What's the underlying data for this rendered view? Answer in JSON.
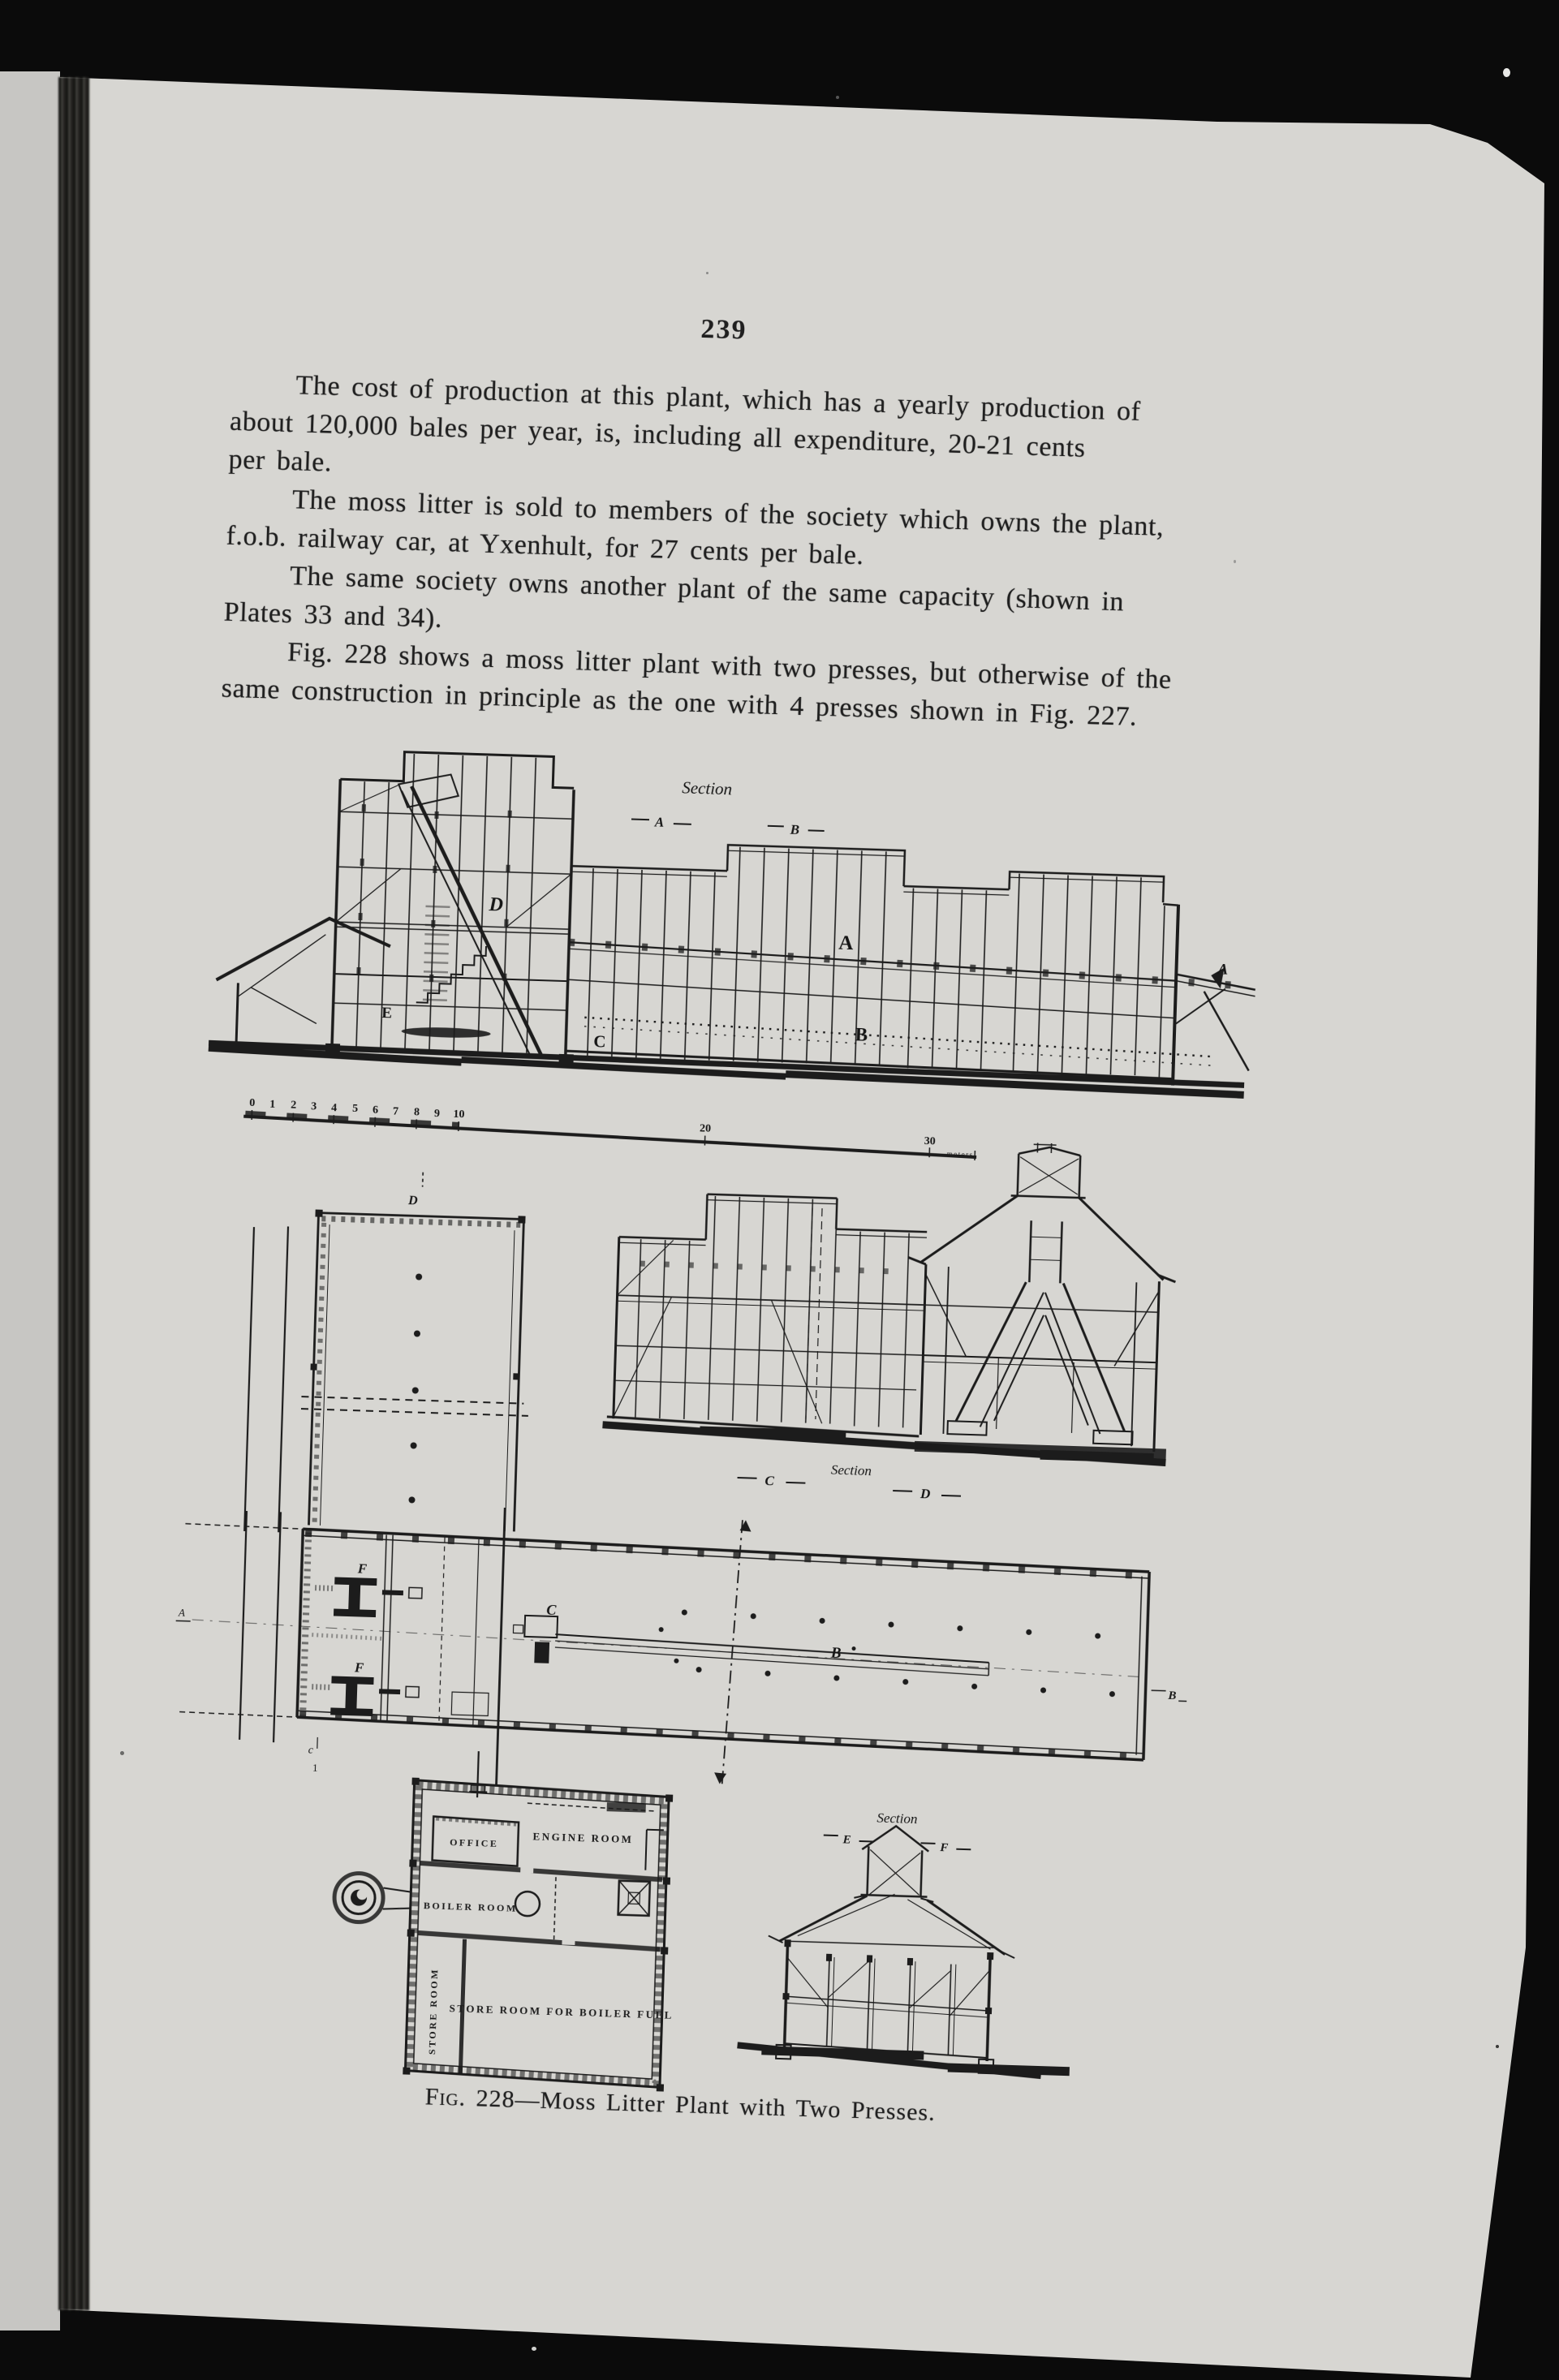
{
  "page_number": "239",
  "text": {
    "lines": [
      {
        "t": "The cost of production at this plant, which has a yearly production of",
        "indent": true
      },
      {
        "t": "about 120,000 bales per year, is, including all expenditure, 20-21 cents",
        "indent": false
      },
      {
        "t": "per bale.",
        "indent": false
      },
      {
        "t": "The moss litter is sold to members of the society which owns the plant,",
        "indent": true
      },
      {
        "t": "f.o.b. railway car, at Yxenhult, for 27 cents per bale.",
        "indent": false
      },
      {
        "t": "The same society owns another plant of the same capacity (shown in",
        "indent": true
      },
      {
        "t": "Plates 33 and 34).",
        "indent": false
      },
      {
        "t": "Fig. 228 shows a moss litter plant with two presses, but otherwise of the",
        "indent": true
      },
      {
        "t": "same construction in principle as the one with 4 presses shown in Fig. 227.",
        "indent": false
      }
    ]
  },
  "caption": {
    "prefix": "Fig. 228",
    "rest": "—Moss Litter Plant with Two Presses."
  },
  "figure": {
    "elevation": {
      "title": "Section",
      "mark_a": "A",
      "mark_b": "B",
      "label_d": "D",
      "label_a_mid": "A",
      "label_a_right": "A",
      "label_b": "B",
      "label_c": "C",
      "label_e": "E"
    },
    "scale": {
      "ticks": [
        "0",
        "1",
        "2",
        "3",
        "4",
        "5",
        "6",
        "7",
        "8",
        "9",
        "10"
      ],
      "t20": "20",
      "t30": "30",
      "unit": "meters"
    },
    "gallery": {
      "mark_d": "D"
    },
    "section_cd": {
      "mark_c": "C",
      "title": "Section",
      "mark_d": "D"
    },
    "plan": {
      "mark_a": "A",
      "mark_b": "B",
      "label_b": "B",
      "label_c": "C",
      "label_f1": "F",
      "label_f2": "F",
      "mark_c1_top": "c",
      "mark_c1_bot": "1"
    },
    "rooms": {
      "office": "OFFICE",
      "engine": "ENGINE ROOM",
      "boiler": "BOILER ROOM",
      "store": "STORE ROOM",
      "fuel": "STORE ROOM FOR BOILER FUEL"
    },
    "section_ef": {
      "title": "Section",
      "mark_e": "E",
      "mark_f": "F"
    }
  }
}
